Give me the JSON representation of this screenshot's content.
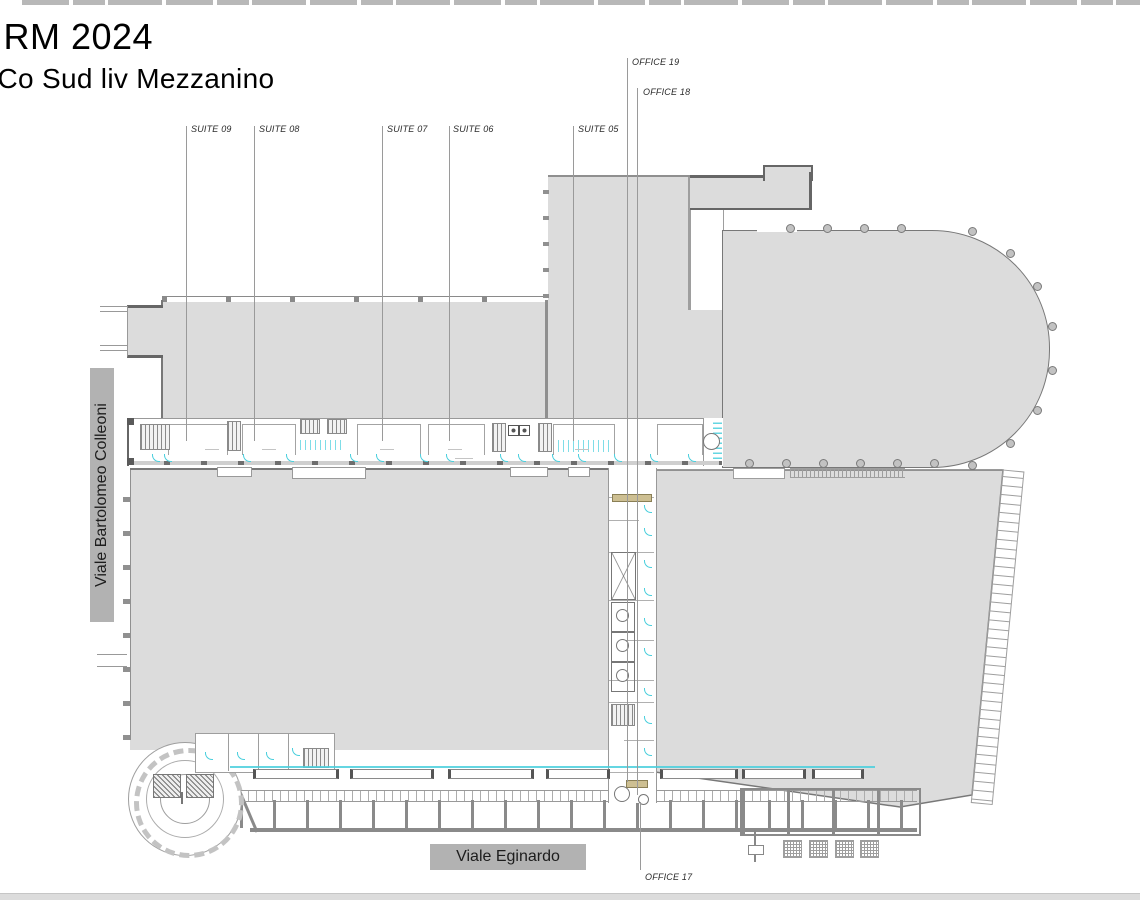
{
  "title": {
    "line1": "IRM 2024",
    "line2": "iCo Sud liv Mezzanino"
  },
  "suite_labels": [
    "SUITE 09",
    "SUITE 08",
    "SUITE 07",
    "SUITE 06",
    "SUITE 05"
  ],
  "office_labels": [
    "OFFICE 19",
    "OFFICE 18",
    "OFFICE 17"
  ],
  "streets": {
    "left": "Viale Bartolomeo Colleoni",
    "bottom": "Viale Eginardo"
  },
  "colors": {
    "plan_fill": "#dcdcdc",
    "wall": "#787878",
    "thin_line": "#9e9e9e",
    "door_accent_cyan": "#49cfdd",
    "street_box": "#b2b2b2",
    "stair_tan": "#cdbf92"
  }
}
